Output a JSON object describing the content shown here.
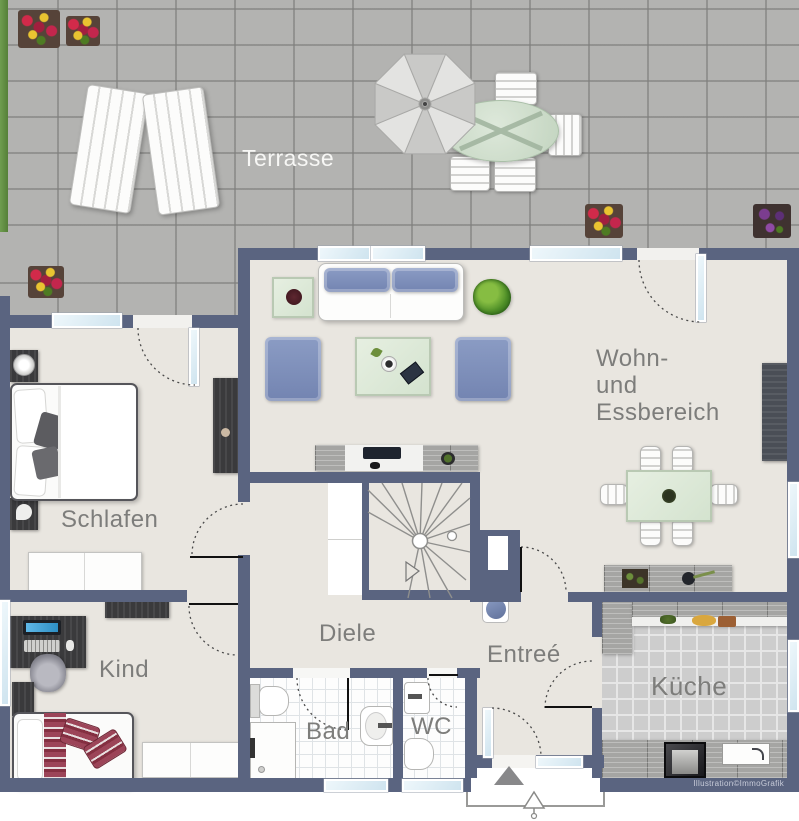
{
  "labels": {
    "terrace": "Terrasse",
    "living": "Wohn-\nund\nEssbereich",
    "bedroom": "Schlafen",
    "child": "Kind",
    "hall": "Diele",
    "bath": "Bad",
    "wc": "WC",
    "entry": "Entreé",
    "kitchen": "Küche"
  },
  "credit": "Illustration©ImmoGrafik",
  "colors": {
    "wall": "#5a6480",
    "floor": "#e9e6e0",
    "terrace_tile": "#b3b3b1",
    "glass": "#cfe4ef",
    "sofa_blue": "#7e90bb",
    "glass_green": "#dfead9",
    "wood_gray": "#a6a6a4",
    "dark_furniture": "#3a3a3c",
    "label_gray": "#7d7d7b",
    "accent_red": "#8f3c4e",
    "plant_green": "#55942c",
    "credit_text": "#c7cbd8"
  }
}
